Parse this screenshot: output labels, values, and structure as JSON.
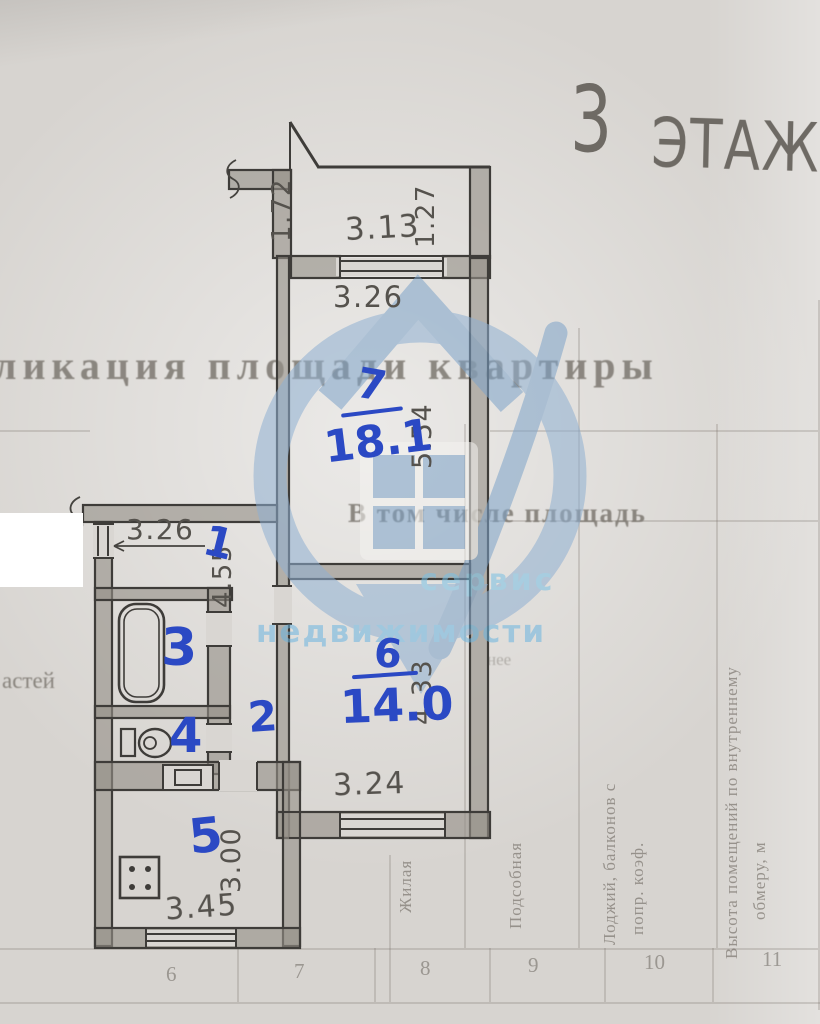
{
  "floor": {
    "number": "3",
    "word": "ЭТАЖ"
  },
  "document": {
    "header_fragment": "ликация площади квартиры",
    "subheader": "В том числе площадь",
    "left_fragment": "астей",
    "right_fragment": "нее",
    "table": {
      "header_lines": [
        "Жилая",
        "Подсобная",
        "Лоджий, балконов с",
        "попр. коэф.",
        "Высота помещений по внутреннему",
        "обмеру, м"
      ],
      "column_numbers": [
        "6",
        "7",
        "8",
        "9",
        "10",
        "11"
      ]
    }
  },
  "watermark": {
    "line1": "сервис",
    "line2": "недвижимости"
  },
  "plan": {
    "rooms": {
      "r1": {
        "number": "1"
      },
      "r2": {
        "number": "2"
      },
      "r3": {
        "number": "3"
      },
      "r4": {
        "number": "4"
      },
      "r5": {
        "number": "5"
      },
      "r6": {
        "number": "6",
        "area": "14.0"
      },
      "r7": {
        "number": "7",
        "area": "18.1"
      }
    },
    "dims": {
      "balcony_side_left": "1.72",
      "balcony_width": "3.13",
      "balcony_side_right": "1.27",
      "room7_width": "3.26",
      "room7_depth": "5.54",
      "room1_width": "3.26",
      "hall_length": "4.55",
      "room6_depth": "4.33",
      "room6_window": "3.24",
      "kitchen_depth": "3.00",
      "kitchen_width": "3.45"
    }
  },
  "colors": {
    "ink_blue": "#2b49c4",
    "pencil": "#55524d",
    "watermark_blue": "#7fa8cd",
    "paper": "#d7d4d0"
  }
}
